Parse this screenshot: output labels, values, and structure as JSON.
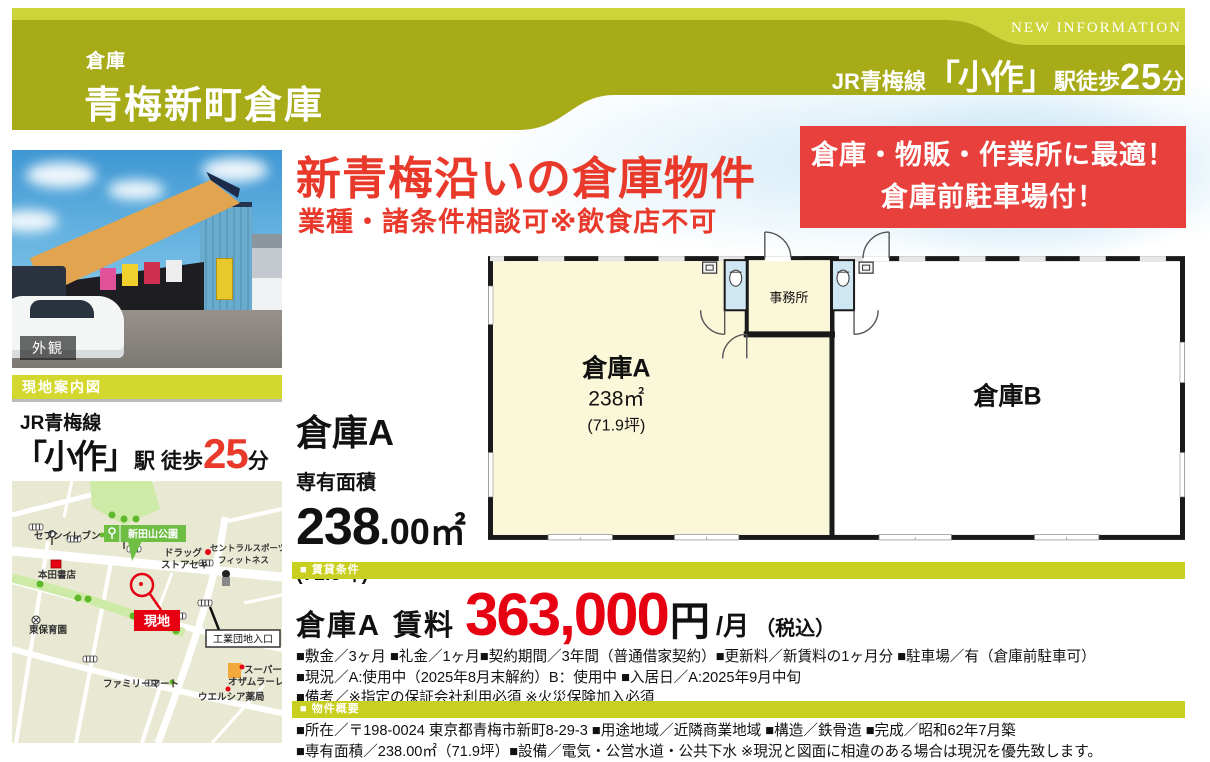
{
  "header": {
    "category": "倉庫",
    "title": "青梅新町倉庫",
    "new_info": "NEW INFORMATION",
    "line": "JR青梅線",
    "station": "「小作」",
    "walk": "駅徒歩",
    "minutes": "25",
    "min_unit": "分"
  },
  "catch": {
    "title": "新青梅沿いの倉庫物件",
    "subtitle": "業種・諸条件相談可※飲食店不可",
    "box_line1": "倉庫・物販・作業所に最適！",
    "box_line2": "倉庫前駐車場付！"
  },
  "photo": {
    "caption": "外観"
  },
  "access": {
    "map_caption": "現地案内図",
    "line": "JR青梅線",
    "station": "「小作」",
    "eki": "駅",
    "walk": "徒歩",
    "minutes": "25",
    "min_unit": "分"
  },
  "map": {
    "park": "新田山公園",
    "seven_eleven": "セブンイレブン",
    "drug1": "ドラッグ",
    "drug2": "ストアセキ",
    "central1": "セントラルスポーツ",
    "central2": "フィットネス",
    "honda": "本田書店",
    "site": "現地",
    "higashi": "東保育園",
    "kogyo": "工業団地入口",
    "family": "ファミリーマート",
    "super1": "スーパー",
    "super2": "オザムラーレ",
    "welcia": "ウエルシア薬局"
  },
  "plan": {
    "room_a": "倉庫A",
    "room_a_area": "238㎡",
    "room_a_tsubo": "(71.9坪)",
    "office": "事務所",
    "room_b": "倉庫B"
  },
  "unit": {
    "name": "倉庫A",
    "area_label": "専有面積",
    "area_int": "238",
    "area_rest": ".00㎡",
    "area_tsubo": "(71.9坪)"
  },
  "lease": {
    "band": "■ 賃貸条件",
    "unit": "倉庫A",
    "label": "賃料",
    "amount": "363,000",
    "yen": "円",
    "per": "/月",
    "tax": "（税込）",
    "terms": [
      "■敷金／3ヶ月 ■礼金／1ヶ月■契約期間／3年間（普通借家契約）■更新料／新賃料の1ヶ月分 ■駐車場／有（倉庫前駐車可）",
      "■現況／A:使用中（2025年8月末解約）B：使用中 ■入居日／A:2025年9月中旬",
      "■備考／※指定の保証会社利用必須 ※火災保険加入必須"
    ]
  },
  "overview": {
    "band": "■ 物件概要",
    "lines": [
      "■所在／〒198-0024 東京都青梅市新町8-29-3 ■用途地域／近隣商業地域 ■構造／鉄骨造 ■完成／昭和62年7月築",
      "■専有面積／238.00㎡（71.9坪）■設備／電気・公営水道・公共下水 ※現況と図面に相違のある場合は現況を優先致します。"
    ]
  },
  "colors": {
    "olive": "#a6ab17",
    "light_olive": "#cdd43a",
    "yellow_band": "#d4d82e",
    "catch_red": "#e8392b",
    "price_red": "#e60012",
    "box_red": "#e8413d",
    "plan_cream": "#fbf7d9",
    "toilet_blue": "#cfe7f2",
    "map_bg": "#e9e9d3",
    "map_green": "#6fbe44"
  }
}
